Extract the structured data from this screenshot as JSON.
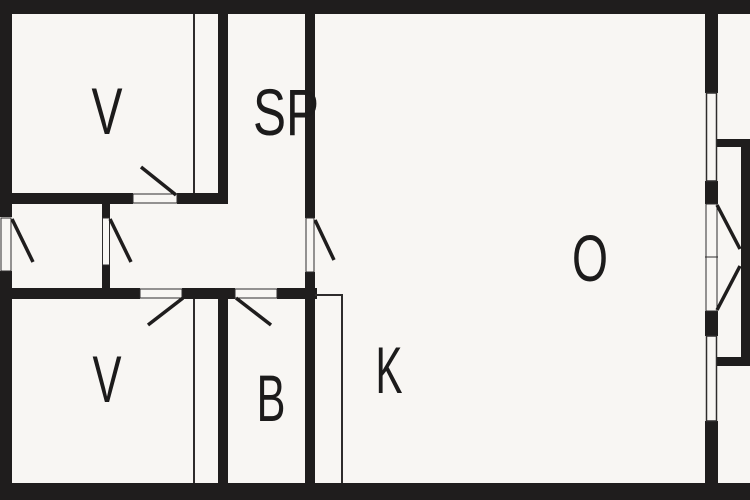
{
  "plan": {
    "rooms": {
      "bedroom_top": {
        "label": "V"
      },
      "sp_room": {
        "label": "SP"
      },
      "living_room": {
        "label": "O"
      },
      "bedroom_bottom": {
        "label": "V"
      },
      "bathroom": {
        "label": "B"
      },
      "kitchen": {
        "label": "K"
      }
    }
  },
  "colors": {
    "background": "#f8f6f3",
    "wall": "#1f1d1d",
    "line": "#2e2c2c",
    "label": "#1c1b1b"
  }
}
